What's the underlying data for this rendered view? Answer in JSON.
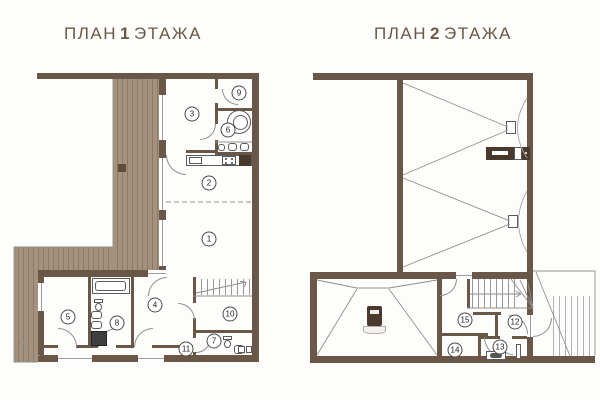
{
  "document": {
    "type": "apartment-floor-plans",
    "language": "ru"
  },
  "colors": {
    "background": "#fdfdfb",
    "wall": "#6b5747",
    "deck": "#a5917d",
    "deck_stripe": "#8d7a66",
    "title_text": "#6d5847",
    "thin_line": "#8f8f8f"
  },
  "plan1": {
    "title": {
      "word1": "ПЛАН",
      "number": "1",
      "word2": "ЭТАЖА"
    },
    "rooms": [
      {
        "number": "1"
      },
      {
        "number": "2"
      },
      {
        "number": "3"
      },
      {
        "number": "4"
      },
      {
        "number": "5"
      },
      {
        "number": "6"
      },
      {
        "number": "7"
      },
      {
        "number": "8"
      },
      {
        "number": "9"
      },
      {
        "number": "10"
      },
      {
        "number": "11"
      }
    ],
    "features": [
      "wood-deck",
      "kitchen-counter",
      "round-bathtub",
      "bathtub",
      "toilet",
      "washbasins",
      "shower-cabin",
      "cooktop",
      "washer-dryer",
      "staircase"
    ]
  },
  "plan2": {
    "title": {
      "word1": "ПЛАН",
      "number": "2",
      "word2": "ЭТАЖА"
    },
    "rooms": [
      {
        "number": "12"
      },
      {
        "number": "13"
      },
      {
        "number": "14"
      },
      {
        "number": "15"
      }
    ],
    "features": [
      "vaulted-roof-lines",
      "skylights",
      "fireplace",
      "wood-stove",
      "winder-staircase",
      "external-staircase",
      "washbasin",
      "shower-panel"
    ]
  }
}
